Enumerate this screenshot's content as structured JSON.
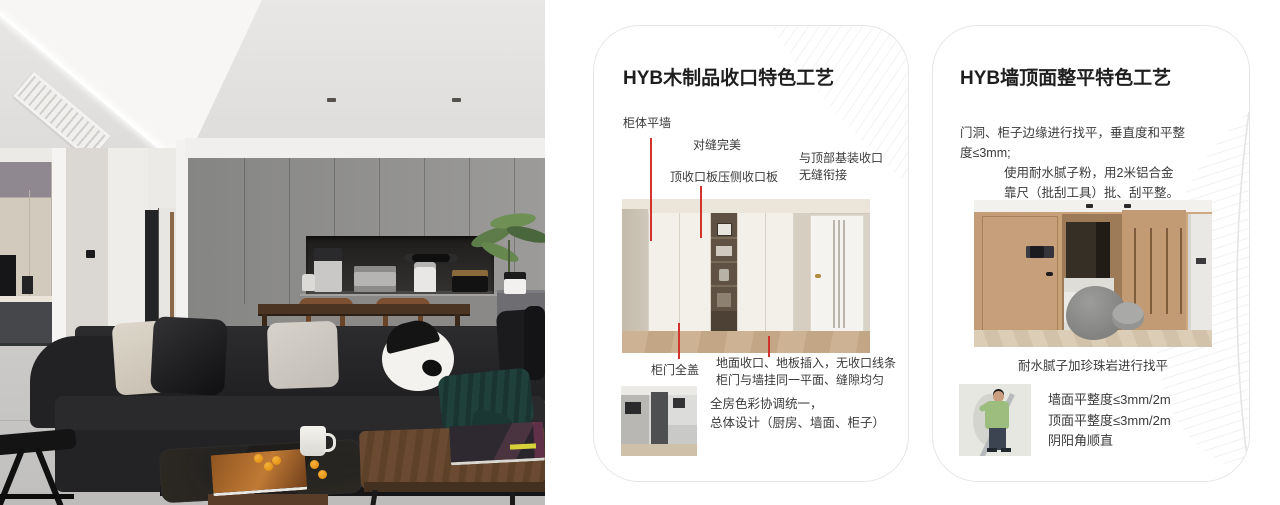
{
  "colors": {
    "accent_red": "#d0342c",
    "card_border": "#e6e6e6",
    "title_text": "#1e1e1e",
    "body_text": "#3a3a3a"
  },
  "card1": {
    "title": "HYB木制品收口特色工艺",
    "annotations": {
      "cabinet_wall": "柜体平墙",
      "seam": "对缝完美",
      "top_board": "顶收口板压侧收口板",
      "top_joint_line1": "与顶部基装收口",
      "top_joint_line2": "无缝衔接",
      "door_cover": "柜门全盖",
      "floor_line1": "地面收口、地板插入，无收口线条",
      "floor_line2": "柜门与墙挂同一平面、缝隙均匀"
    },
    "summary_line1": "全房色彩协调统一，",
    "summary_line2": "总体设计（厨房、墙面、柜子）"
  },
  "card2": {
    "title": "HYB墙顶面整平特色工艺",
    "para1_line1": "门洞、柜子边缘进行找平，垂直度和平整",
    "para1_line2": "度≤3mm;",
    "para2_line1": "使用耐水腻子粉，用2米铝合金",
    "para2_line2": "靠尺（批刮工具）批、刮平整。",
    "caption": "耐水腻子加珍珠岩进行找平",
    "metrics": [
      "墙面平整度≤3mm/2m",
      "顶面平整度≤3mm/2m",
      "阴阳角顺直"
    ]
  }
}
